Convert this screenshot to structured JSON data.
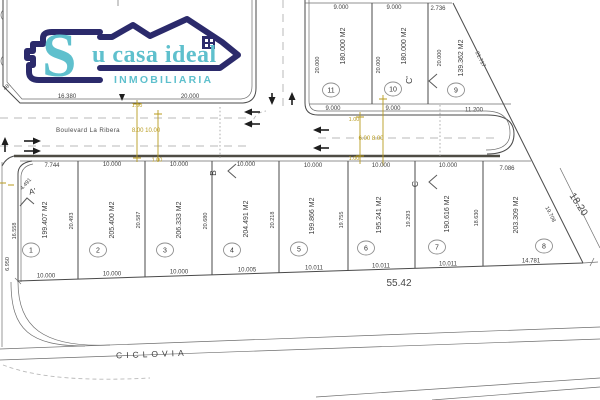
{
  "brand": {
    "s": "S",
    "rest": "u casa ideal",
    "subtitle": "INMOBILIARIA"
  },
  "colors": {
    "logo_navy": "#2b2a6b",
    "logo_teal": "#5fc0cd",
    "dim_yellow": "#b89b1e"
  },
  "roads": {
    "boulevard": "Boulevard La Ribera",
    "ciclovia": "CICLOVIA",
    "west_dims": "8.00  10.00",
    "east_dims": "6.00  8.00",
    "lane_w1": "1.00",
    "lane_w2": "1.00",
    "lane_e1": "1.00",
    "lane_e2": "1.00"
  },
  "block_nw": {
    "front_a": "16.380",
    "front_b": "20.000",
    "chamfer": "48."
  },
  "north_lots": [
    {
      "num": "11",
      "area": "180.000 M2",
      "front": "9.000",
      "side": "20.000",
      "back": "9.000"
    },
    {
      "num": "10",
      "area": "180.000 M2",
      "front": "9.000",
      "side": "20.000",
      "back": "9.000"
    },
    {
      "num": "9",
      "area": "139.362 M2",
      "front": "2.736",
      "side": "20.000",
      "back": "11.200",
      "diag": "21.717"
    }
  ],
  "south_lots": [
    {
      "num": "1",
      "area": "199.407 M2",
      "front": "7.744",
      "side": "20.493",
      "back": "10.000"
    },
    {
      "num": "2",
      "area": "205.400 M2",
      "front": "10.000",
      "side": "20.587",
      "back": "10.000"
    },
    {
      "num": "3",
      "area": "206.333 M2",
      "front": "10.000",
      "side": "20.680",
      "back": "10.000"
    },
    {
      "num": "4",
      "area": "204.491 M2",
      "front": "10.000",
      "side": "20.218",
      "back": "10.005"
    },
    {
      "num": "5",
      "area": "199.866 M2",
      "front": "10.000",
      "side": "19.755",
      "back": "10.011"
    },
    {
      "num": "6",
      "area": "195.241 M2",
      "front": "10.000",
      "side": "19.293",
      "back": "10.011"
    },
    {
      "num": "7",
      "area": "190.616 M2",
      "front": "10.000",
      "side": "18.630",
      "back": "10.011"
    },
    {
      "num": "8",
      "area": "203.309 M2",
      "front": "7.086",
      "side": "19.708",
      "back": "14.781"
    }
  ],
  "sections": {
    "a": "A'",
    "b": "B",
    "c": "C",
    "c_prime": "C'"
  },
  "dims": {
    "total": "55.42",
    "boundary": "18.20",
    "lot1_left": "16.558",
    "street_left": "6.950",
    "corner_curve": "4.491"
  }
}
